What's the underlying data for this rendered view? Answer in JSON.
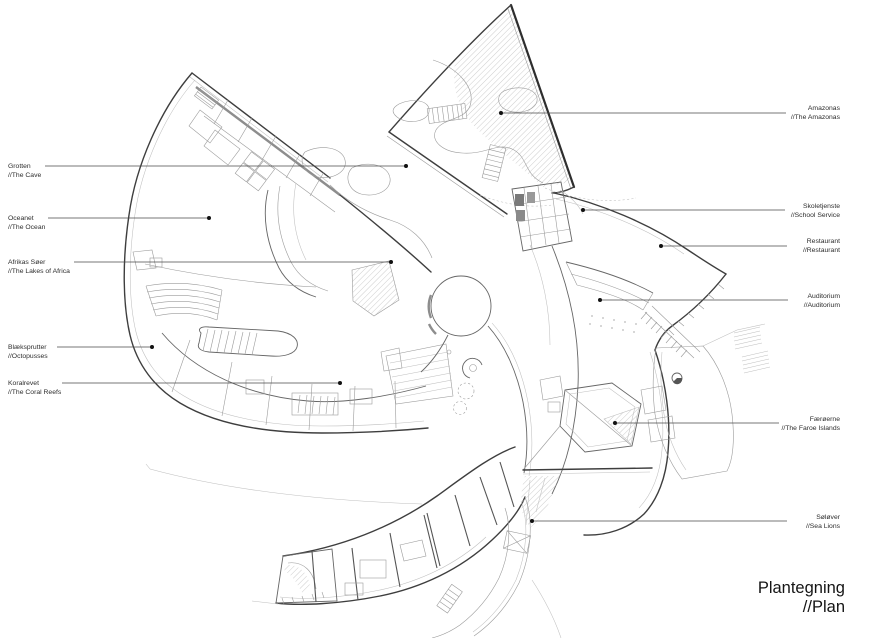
{
  "title": {
    "line1": "Plantegning",
    "line2": "//Plan"
  },
  "labels": {
    "left": [
      {
        "da": "Grotten",
        "en": "//The Cave"
      },
      {
        "da": "Oceanet",
        "en": "//The Ocean"
      },
      {
        "da": "Afrikas Søer",
        "en": "//The Lakes of Africa"
      },
      {
        "da": "Blæksprutter",
        "en": "//Octopusses"
      },
      {
        "da": "Koralrevet",
        "en": "//The Coral Reefs"
      }
    ],
    "right": [
      {
        "da": "Amazonas",
        "en": "//The Amazonas"
      },
      {
        "da": "Skoletjenste",
        "en": "//School Service"
      },
      {
        "da": "Restaurant",
        "en": "//Restaurant"
      },
      {
        "da": "Auditorium",
        "en": "//Auditorium"
      },
      {
        "da": "Færøerne",
        "en": "//The Faroe Islands"
      },
      {
        "da": "Søløver",
        "en": "//Sea Lions"
      }
    ]
  },
  "colors": {
    "background": "#ffffff",
    "line_dark": "#3e3e3e",
    "line_mid": "#666666",
    "line_light": "#9b9b9b",
    "hatch": "#b8b8b8",
    "leader": "#4a4a4a",
    "text": "#2d2d2d"
  }
}
